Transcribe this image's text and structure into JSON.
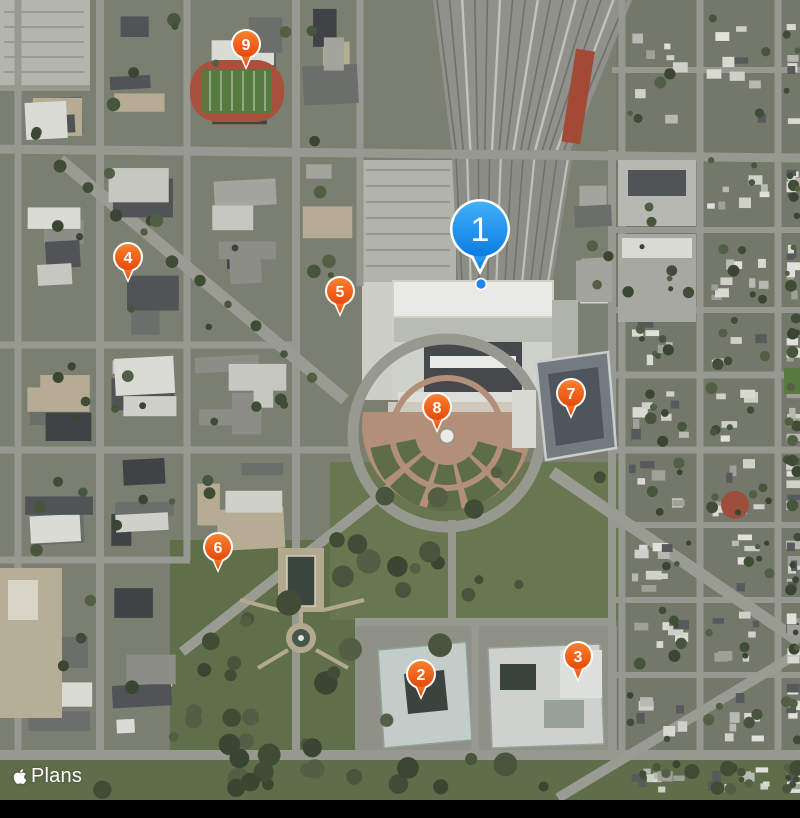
{
  "app": {
    "name": "Plans",
    "view_mode": "satellite"
  },
  "attribution": {
    "label": "Plans",
    "icon": "apple-logo"
  },
  "map": {
    "selected_anchor_dot": {
      "x": 481,
      "y": 284
    },
    "markers": [
      {
        "label": "1",
        "kind": "selected",
        "x": 480,
        "y": 229
      },
      {
        "label": "2",
        "kind": "poi",
        "x": 421,
        "y": 674
      },
      {
        "label": "3",
        "kind": "poi",
        "x": 578,
        "y": 656
      },
      {
        "label": "4",
        "kind": "poi",
        "x": 128,
        "y": 257
      },
      {
        "label": "5",
        "kind": "poi",
        "x": 340,
        "y": 291
      },
      {
        "label": "6",
        "kind": "poi",
        "x": 218,
        "y": 547
      },
      {
        "label": "7",
        "kind": "poi",
        "x": 571,
        "y": 393
      },
      {
        "label": "8",
        "kind": "poi",
        "x": 437,
        "y": 407
      },
      {
        "label": "9",
        "kind": "poi",
        "x": 246,
        "y": 44
      }
    ]
  },
  "colors": {
    "poi_top": "#fb8030",
    "poi_bottom": "#e64a0b",
    "selected_top": "#43b0f8",
    "selected_bottom": "#0b7ce2",
    "anchor_dot": "#1d86e8",
    "pin_border": "#ffffff",
    "pin_text": "#ffffff"
  }
}
